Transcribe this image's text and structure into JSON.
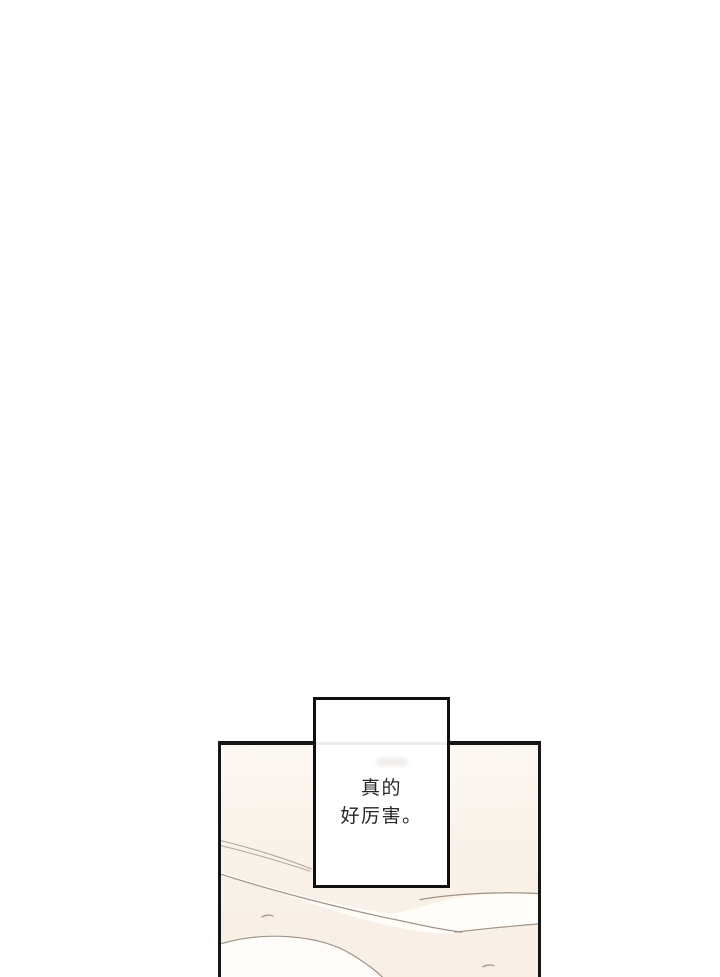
{
  "page_type": "webtoon-comic-page",
  "speech_bubble": {
    "lines": [
      "真的",
      "好厉害。"
    ]
  },
  "panel": {
    "artwork_description": "abstract cream background with thin curved path lines and a pale winding band"
  },
  "colors": {
    "page_bg": "#ffffff",
    "bubble_bg": "#ffffff",
    "bubble_border": "#0f0f0f",
    "text_color": "#262626",
    "panel_border": "#161616",
    "panel_bg_top": "#fcf8f2",
    "panel_bg_mid": "#f9f2e9",
    "panel_bg_bottom": "#f8efe5",
    "art_line": "#8a7a6d",
    "art_white": "#fffefb"
  }
}
